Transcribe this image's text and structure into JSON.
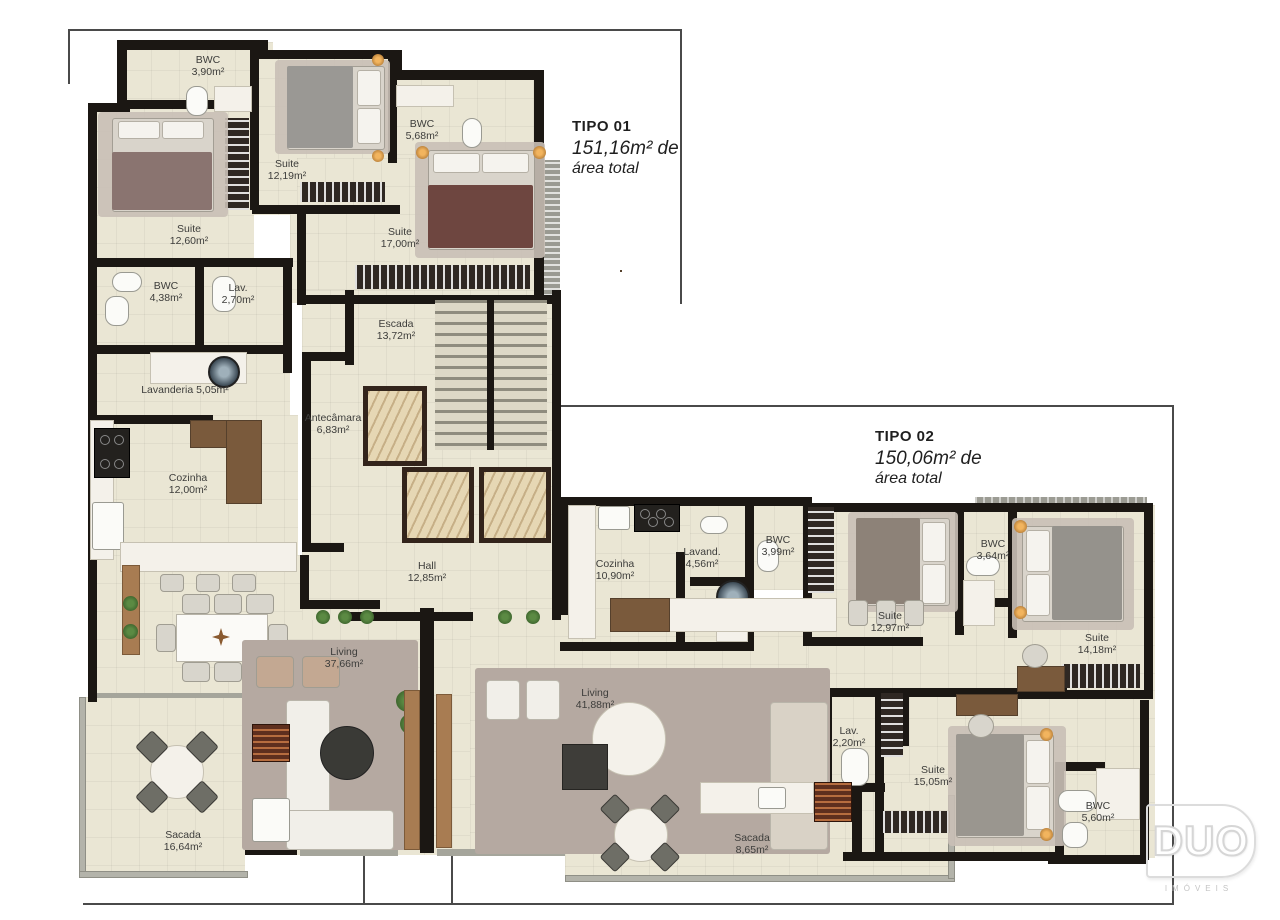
{
  "tipo01": {
    "title": "TIPO 01",
    "area_line": "151,16m² de",
    "area_line2": "área total"
  },
  "tipo02": {
    "title": "TIPO 02",
    "area_line": "150,06m² de",
    "area_line2": "área total"
  },
  "rooms": [
    {
      "name": "BWC",
      "area": "3,90m²"
    },
    {
      "name": "Suite",
      "area": "12,19m²"
    },
    {
      "name": "BWC",
      "area": "5,68m²"
    },
    {
      "name": "Suite",
      "area": "12,60m²"
    },
    {
      "name": "Suite",
      "area": "17,00m²"
    },
    {
      "name": "BWC",
      "area": "4,38m²"
    },
    {
      "name": "Lav.",
      "area": "2,70m²"
    },
    {
      "name": "Escada",
      "area": "13,72m²"
    },
    {
      "name": "Lavanderia 5,05m²",
      "area": ""
    },
    {
      "name": "Antecâmara",
      "area": "6,83m²"
    },
    {
      "name": "Cozinha",
      "area": "12,00m²"
    },
    {
      "name": "Hall",
      "area": "12,85m²"
    },
    {
      "name": "Living",
      "area": "37,66m²"
    },
    {
      "name": "Sacada",
      "area": "16,64m²"
    },
    {
      "name": "Cozinha",
      "area": "10,90m²"
    },
    {
      "name": "Lavand.",
      "area": "4,56m²"
    },
    {
      "name": "BWC",
      "area": "3,99m²"
    },
    {
      "name": "Suite",
      "area": "12,97m²"
    },
    {
      "name": "BWC",
      "area": "3,64m²"
    },
    {
      "name": "Suite",
      "area": "14,18m²"
    },
    {
      "name": "Living",
      "area": "41,88m²"
    },
    {
      "name": "Lav.",
      "area": "2,20m²"
    },
    {
      "name": "Suite",
      "area": "15,05m²"
    },
    {
      "name": "BWC",
      "area": "5,60m²"
    },
    {
      "name": "Sacada",
      "area": "8,65m²"
    }
  ],
  "logo": {
    "name": "DUO",
    "sub": "IMÓVEIS"
  },
  "colors": {
    "wall": "#1b1713",
    "floor": "#eae6d4",
    "boundary": "#4a4a4a"
  }
}
